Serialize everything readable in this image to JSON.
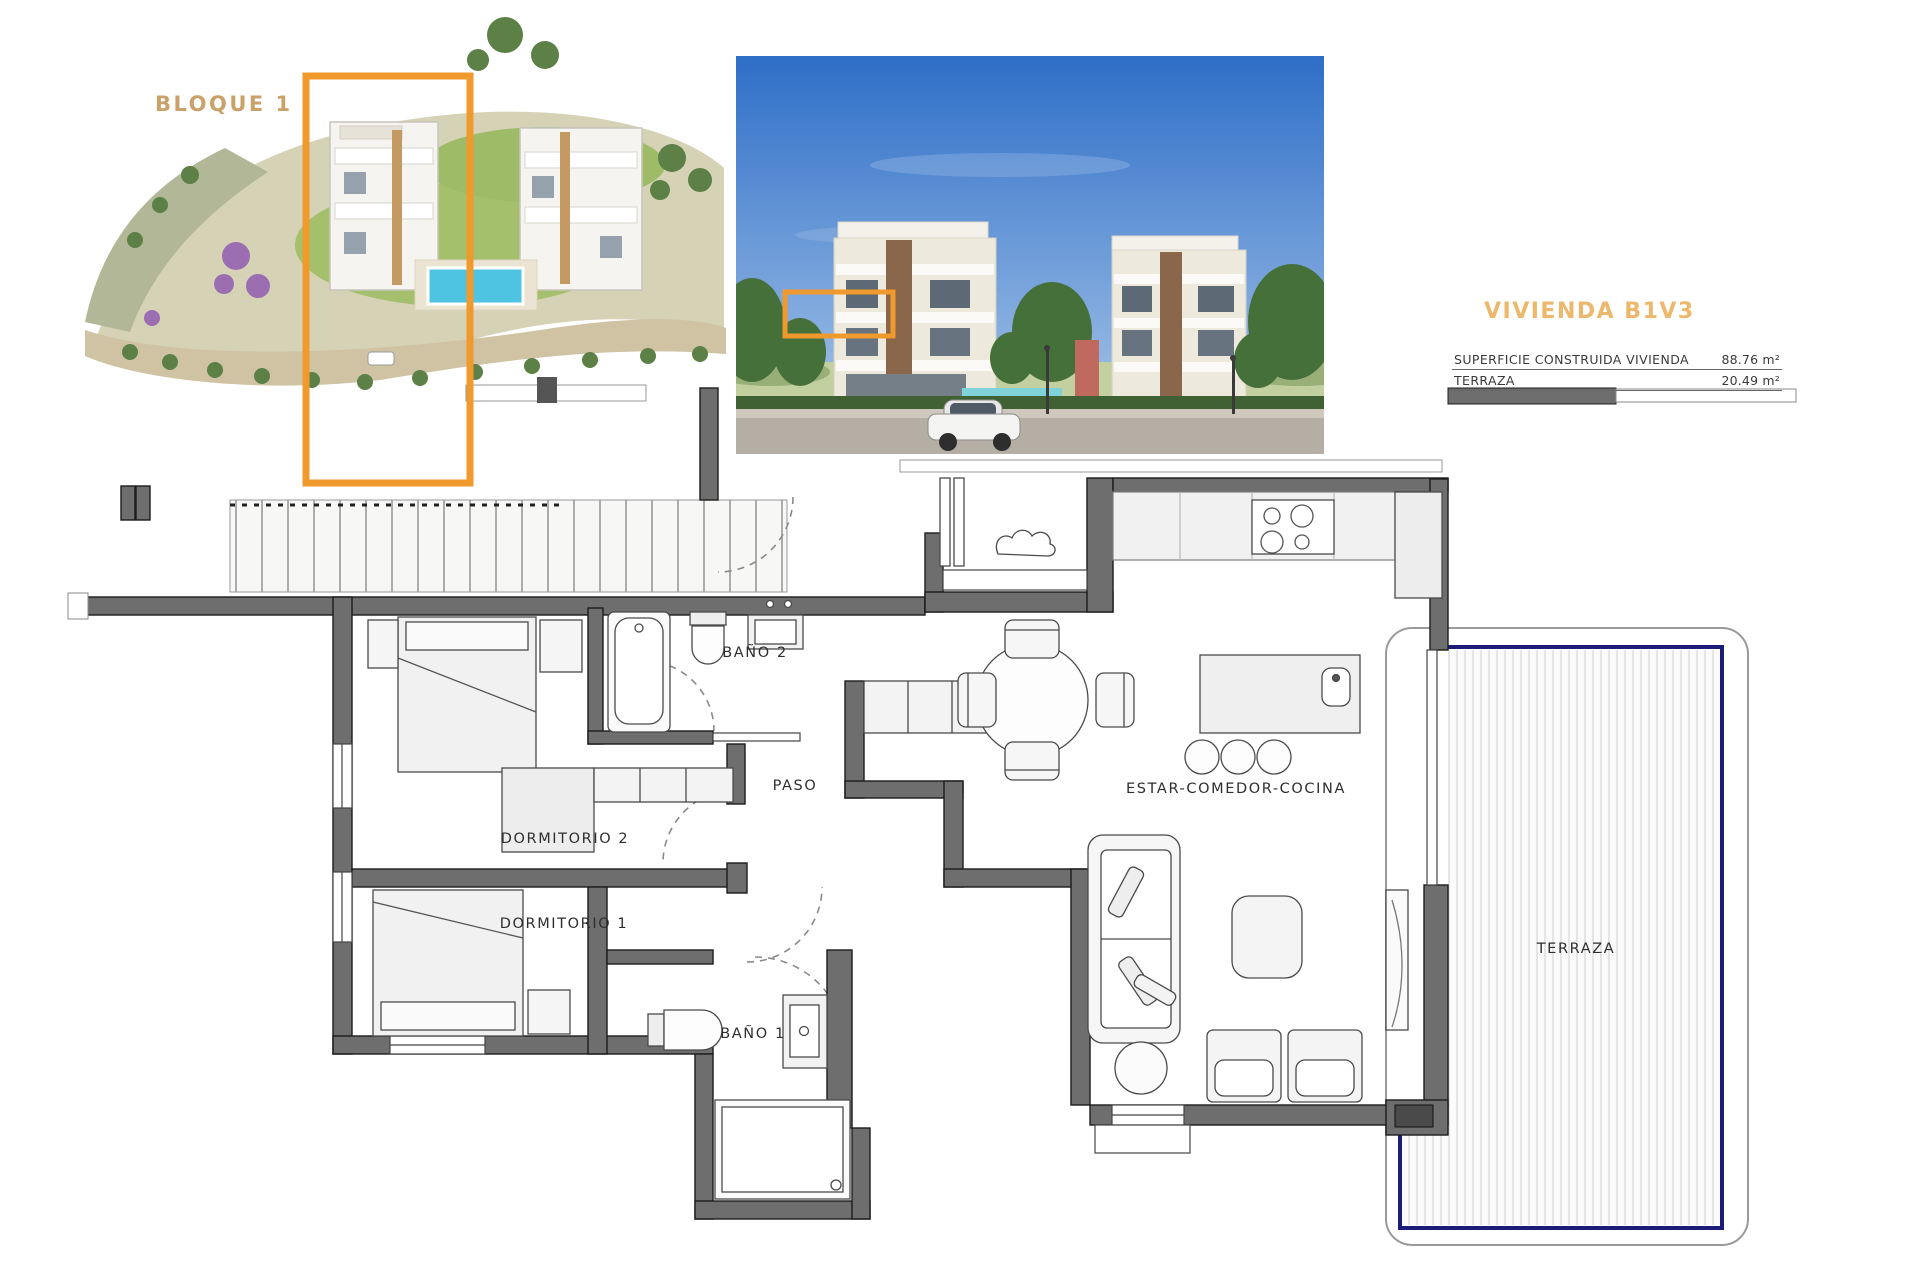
{
  "header": {
    "block_label": "BLOQUE 1",
    "unit_title": "VIVIENDA B1V3"
  },
  "area_table": {
    "rows": [
      {
        "label": "SUPERFICIE CONSTRUIDA VIVIENDA",
        "value": "88.76 m²"
      },
      {
        "label": "TERRAZA",
        "value": "20.49 m²"
      }
    ]
  },
  "floor_plan": {
    "rooms": {
      "dormitorio_2": "DORMITORIO 2",
      "dormitorio_1": "DORMITORIO 1",
      "bano_2": "BAÑO 2",
      "bano_1": "BAÑO 1",
      "paso": "PASO",
      "estar_comedor_cocina": "ESTAR-COMEDOR-COCINA",
      "terraza": "TERRAZA"
    }
  },
  "colors": {
    "highlight_orange": "#F09A2E",
    "block_label_gold": "#C9A169",
    "unit_title_gold": "#EDB76C",
    "wall_gray": "#6e6e6e",
    "terrace_line_navy": "#1b1b78",
    "pool_cyan": "#4fc4e2",
    "sky_blue": "#2e6ec7"
  }
}
